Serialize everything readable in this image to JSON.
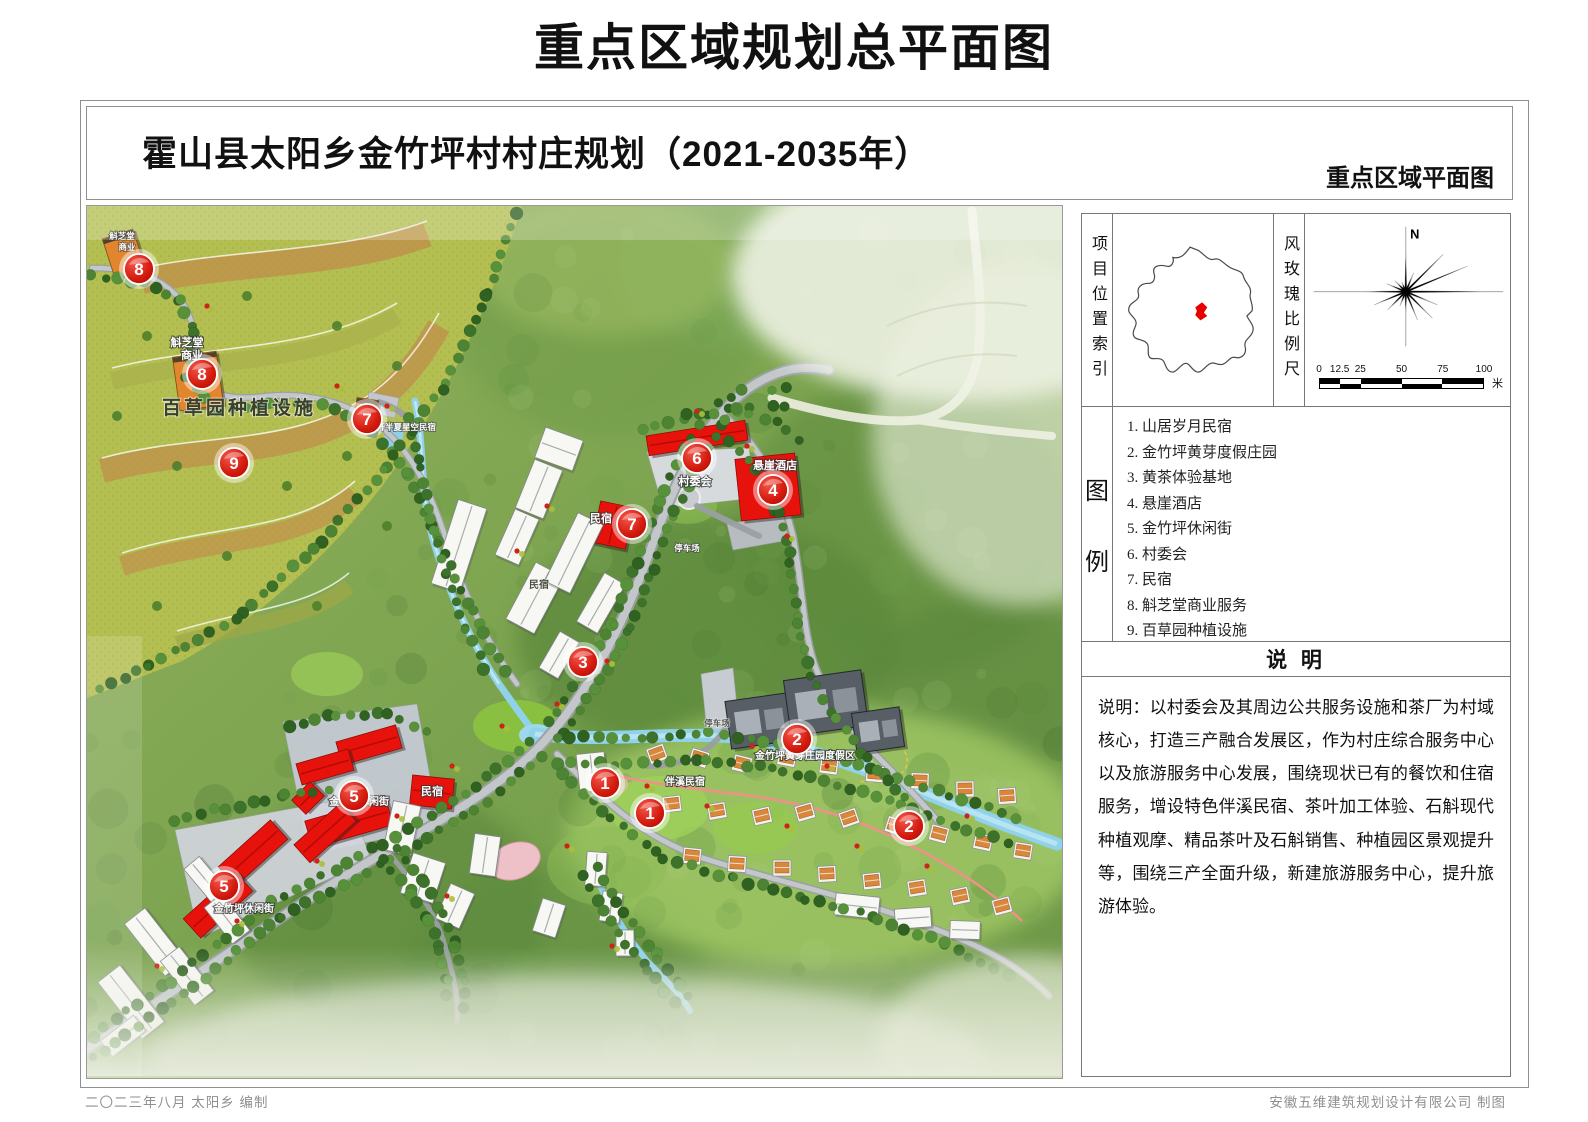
{
  "page": {
    "title": "重点区域规划总平面图"
  },
  "header": {
    "subtitle": "霍山县太阳乡金竹坪村村庄规划（2021-2035年）",
    "corner_label": "重点区域平面图"
  },
  "panel": {
    "location_index_label": "项目位置索引",
    "windrose_label": "风玫瑰比例尺",
    "north_label": "N",
    "scale_ticks": [
      "0",
      "12.5",
      "25",
      "50",
      "75",
      "100"
    ],
    "scale_unit": "米",
    "legend_label_chars": [
      "图",
      "例"
    ],
    "legend_items": [
      "1. 山居岁月民宿",
      "2. 金竹坪黄芽度假庄园",
      "3. 黄茶体验基地",
      "4. 悬崖酒店",
      "5. 金竹坪休闲街",
      "6. 村委会",
      "7. 民宿",
      "8. 斛芝堂商业服务",
      "9. 百草园种植设施"
    ],
    "notes_header": "说 明",
    "notes_text": "说明：以村委会及其周边公共服务设施和茶厂为村域核心，打造三产融合发展区，作为村庄综合服务中心以及旅游服务中心发展，围绕现状已有的餐饮和住宿服务，增设特色伴溪民宿、茶叶加工体验、石斛现代种植观摩、精品茶叶及石斛销售、种植园区景观提升等，围绕三产全面升级，新建旅游服务中心，提升旅游体验。"
  },
  "map": {
    "markers": [
      {
        "n": "8",
        "x": 52,
        "y": 63
      },
      {
        "n": "8",
        "x": 115,
        "y": 168
      },
      {
        "n": "9",
        "x": 147,
        "y": 257
      },
      {
        "n": "7",
        "x": 280,
        "y": 213
      },
      {
        "n": "7",
        "x": 545,
        "y": 318
      },
      {
        "n": "6",
        "x": 610,
        "y": 252
      },
      {
        "n": "4",
        "x": 686,
        "y": 284
      },
      {
        "n": "3",
        "x": 496,
        "y": 456
      },
      {
        "n": "5",
        "x": 267,
        "y": 590
      },
      {
        "n": "5",
        "x": 137,
        "y": 680
      },
      {
        "n": "1",
        "x": 518,
        "y": 577
      },
      {
        "n": "1",
        "x": 563,
        "y": 607
      },
      {
        "n": "2",
        "x": 710,
        "y": 533
      },
      {
        "n": "2",
        "x": 822,
        "y": 620
      }
    ],
    "labels": [
      {
        "text": "百草园种植设施",
        "x": 152,
        "y": 208,
        "cls": "big-dark"
      },
      {
        "text": "斛芝堂",
        "x": 35,
        "y": 33,
        "cls": "tiny-white"
      },
      {
        "text": "商业",
        "x": 40,
        "y": 44,
        "cls": "tiny-white"
      },
      {
        "text": "斛芝堂",
        "x": 100,
        "y": 140,
        "cls": "small-white"
      },
      {
        "text": "商业",
        "x": 105,
        "y": 153,
        "cls": "small-white"
      },
      {
        "text": "花开半夏星空民宿",
        "x": 315,
        "y": 224,
        "cls": "tiny-white"
      },
      {
        "text": "村委会",
        "x": 608,
        "y": 279,
        "cls": "small-white"
      },
      {
        "text": "悬崖酒店",
        "x": 688,
        "y": 263,
        "cls": "small-white"
      },
      {
        "text": "民宿",
        "x": 514,
        "y": 316,
        "cls": "small-white"
      },
      {
        "text": "民宿",
        "x": 452,
        "y": 382,
        "cls": "small-dark"
      },
      {
        "text": "停车场",
        "x": 600,
        "y": 345,
        "cls": "tiny-white"
      },
      {
        "text": "停车场",
        "x": 630,
        "y": 520,
        "cls": "tiny-dark"
      },
      {
        "text": "金竹坪休闲街",
        "x": 272,
        "y": 599,
        "cls": "med-white"
      },
      {
        "text": "金竹坪休闲街",
        "x": 157,
        "y": 706,
        "cls": "med-white"
      },
      {
        "text": "民宿",
        "x": 345,
        "y": 589,
        "cls": "small-white"
      },
      {
        "text": "金竹坪黄芽庄园度假区",
        "x": 718,
        "y": 553,
        "cls": "med-white"
      },
      {
        "text": "伴溪民宿",
        "x": 598,
        "y": 579,
        "cls": "med-white"
      }
    ]
  },
  "footer": {
    "left": "二〇二三年八月  太阳乡   编制",
    "right": "安徽五维建筑规划设计有限公司  制图"
  }
}
